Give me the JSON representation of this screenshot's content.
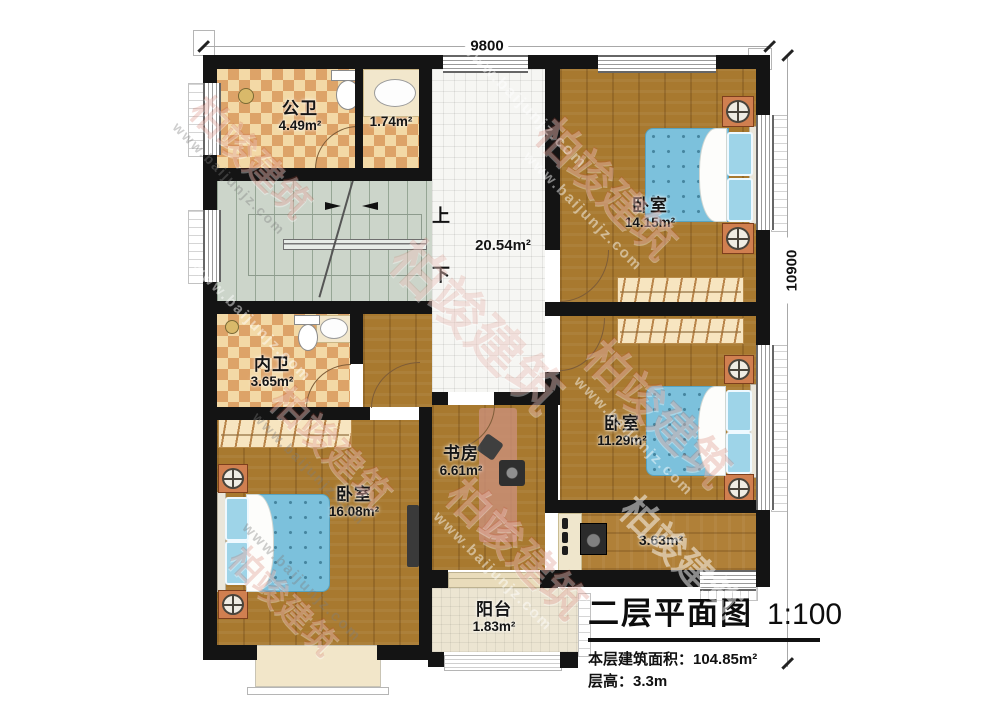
{
  "plan": {
    "dimension_top": "9800",
    "dimension_right": "10900",
    "stair_up": "上",
    "stair_down": "下",
    "rooms": [
      {
        "id": "public-bath",
        "name": "公卫",
        "area": "4.49m²"
      },
      {
        "id": "washroom",
        "name": "",
        "area": "1.74m²"
      },
      {
        "id": "corridor",
        "name": "",
        "area": "20.54m²"
      },
      {
        "id": "bedroom-top-right",
        "name": "卧室",
        "area": "14.15m²"
      },
      {
        "id": "ensuite-bath",
        "name": "内卫",
        "area": "3.65m²"
      },
      {
        "id": "study",
        "name": "书房",
        "area": "6.61m²"
      },
      {
        "id": "bedroom-right",
        "name": "卧室",
        "area": "11.29m²"
      },
      {
        "id": "bedroom-left",
        "name": "卧室",
        "area": "16.08m²"
      },
      {
        "id": "hallway",
        "name": "",
        "area": "3.63m²"
      },
      {
        "id": "balcony",
        "name": "阳台",
        "area": "1.83m²"
      }
    ]
  },
  "title_block": {
    "title": "二层平面图",
    "scale": "1:100",
    "building_area": "本层建筑面积：104.85m²",
    "floor_height": "层高：3.3m"
  },
  "watermark": {
    "cn": "柏竣建筑",
    "url": "www.baijunjz.com"
  },
  "colors": {
    "wall": "#141414",
    "wood_floor": "#a8792f",
    "tile_light": "#f3d9a6",
    "tile_dark": "#dda368",
    "corridor_tile": "#f6f6f3",
    "stair_floor": "#ccd5ca",
    "bed_blue": "#7cc1dc",
    "balcony_floor": "#ece5d2",
    "nightstand_orange": "#d07f50",
    "watermark_red": "#c34632",
    "title_text": "#111111"
  }
}
